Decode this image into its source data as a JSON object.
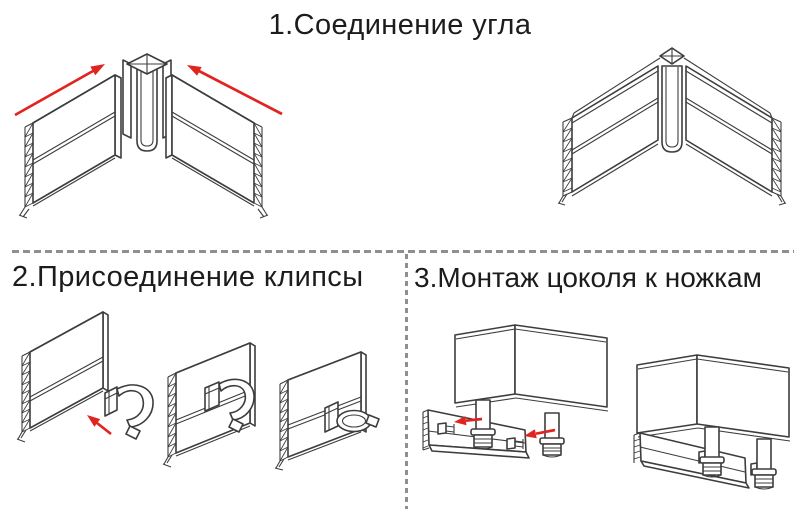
{
  "page": {
    "background": "#ffffff"
  },
  "palette": {
    "line": "#3d3d3d",
    "arrow_red": "#e02420",
    "divider_gray": "#8f8f8f",
    "text": "#1c1c1c"
  },
  "icons": {
    "direction-arrow-icon": "➤ (solid red arrow indicating sliding direction)"
  },
  "steps": {
    "step1": {
      "title": "1.Соединение угла",
      "diagrams": [
        "corner-joint-exploded",
        "corner-joint-assembled"
      ]
    },
    "step2": {
      "title": "2.Присоединение клипсы",
      "diagrams": [
        "panel-with-loose-clip",
        "panel-with-clip-inserted",
        "panel-with-clip-locked"
      ]
    },
    "step3": {
      "title": "3.Монтаж цоколя к ножкам",
      "diagrams": [
        "cabinet-legs-plinth-exploded",
        "cabinet-plinth-mounted"
      ]
    }
  }
}
